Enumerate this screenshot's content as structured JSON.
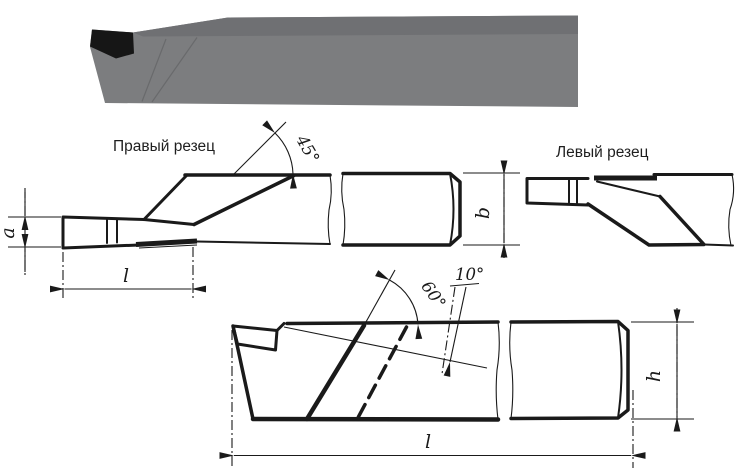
{
  "drawing": {
    "labels": {
      "right_cutter": "Правый резец",
      "left_cutter": "Левый  резец"
    },
    "angles": {
      "plan_approach": "45°",
      "main_entering": "60°",
      "rake": "10°"
    },
    "dimensions": {
      "blade_width": "a",
      "shank_width": "b",
      "head_length": "l",
      "shank_height": "h",
      "total_length": "l"
    },
    "colors": {
      "line": "#1a1a1a",
      "render_top": "#6f7073",
      "render_front": "#7c7d7f",
      "render_edge": "#696a6c",
      "render_insert": "#161616",
      "background": "#ffffff"
    }
  }
}
